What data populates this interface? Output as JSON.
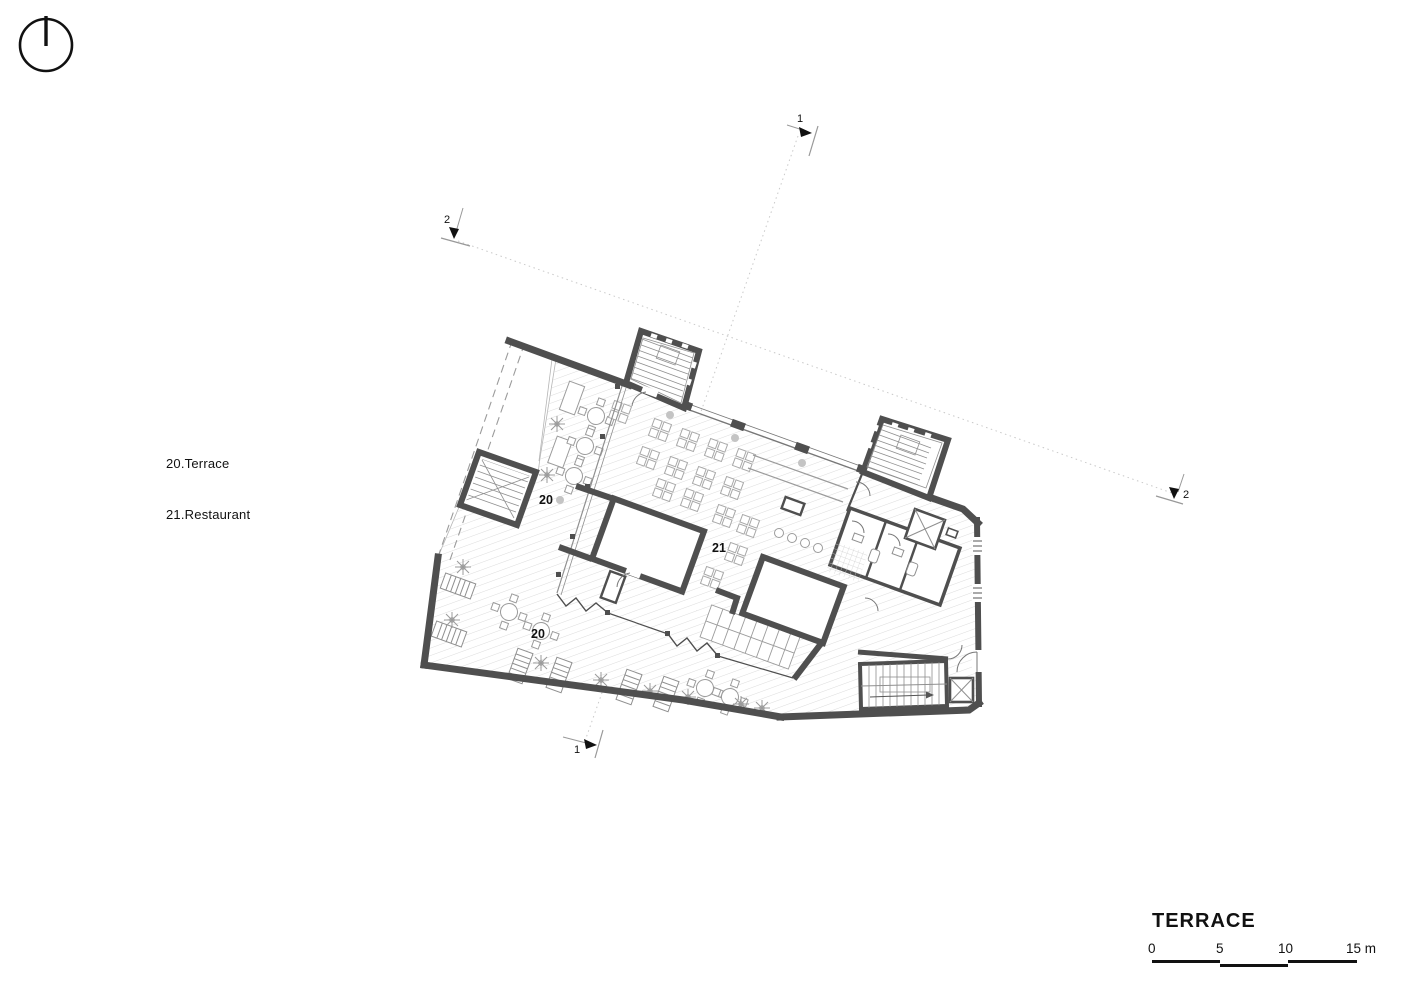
{
  "drawing": {
    "legend": {
      "line1": "20.Terrace",
      "line2": "21.Restaurant"
    },
    "room_labels": {
      "terrace_upper": "20",
      "restaurant": "21",
      "terrace_lower": "20"
    },
    "section_markers": {
      "top": "1",
      "bottom": "1",
      "left": "2",
      "right": "2"
    },
    "title": "TERRACE",
    "scale_bar": {
      "t0": "0",
      "t5": "5",
      "t10": "10",
      "t15": "15 m"
    },
    "colors": {
      "walls": "#4f4f4f",
      "hatch": "#dcdcdc",
      "thin_lines": "#999999",
      "section_line": "#c9c9c9",
      "text": "#111111",
      "background": "#ffffff"
    }
  }
}
